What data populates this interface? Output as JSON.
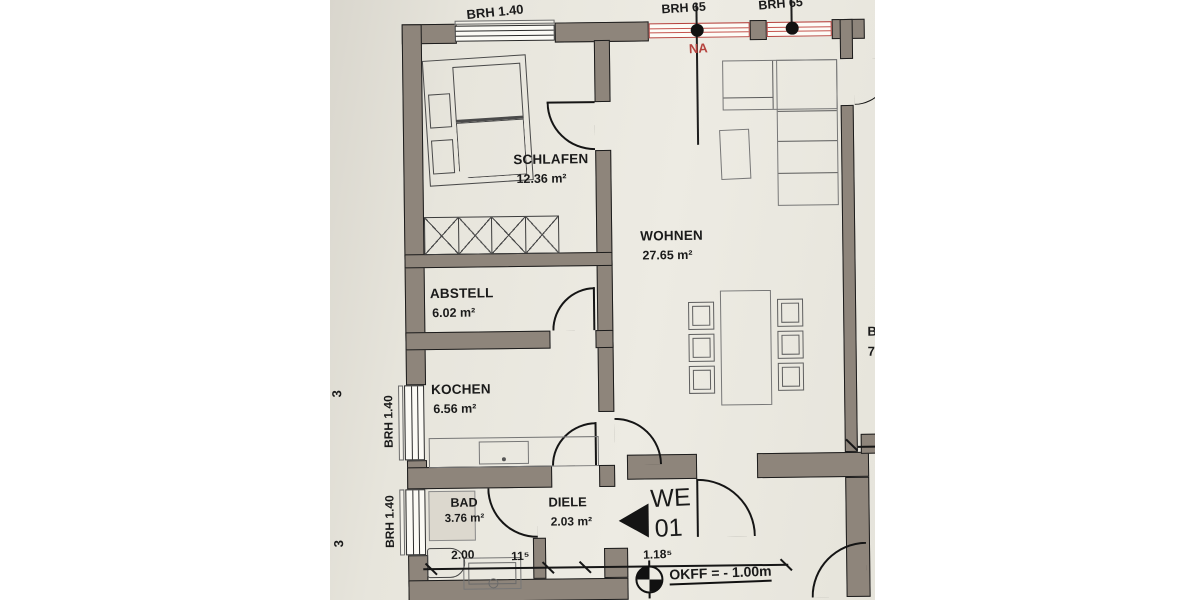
{
  "palette": {
    "paper": "#e9e6dd",
    "wall_grey": "#8e857b",
    "ink": "#1a1a1a",
    "window_red": "#b5433e"
  },
  "rooms": {
    "schlafen": {
      "name": "SCHLAFEN",
      "area": "12.36 m²"
    },
    "wohnen": {
      "name": "WOHNEN",
      "area": "27.65 m²"
    },
    "abstell": {
      "name": "ABSTELL",
      "area": "6.02 m²"
    },
    "kochen": {
      "name": "KOCHEN",
      "area": "6.56 m²"
    },
    "bad": {
      "name": "BAD",
      "area": "3.76 m²"
    },
    "diele": {
      "name": "DIELE",
      "area": "2.03 m²"
    }
  },
  "window_labels": {
    "top_schlafen": "BRH 1.40",
    "top_wohnen_left": "BRH 65",
    "top_wohnen_right": "BRH 65",
    "left_kochen": "BRH 1.40",
    "left_bad": "BRH 1.40",
    "na": "NA"
  },
  "dimensions": {
    "bad_width": "2.00",
    "wall_thickness": "11⁵",
    "diele_width": "1.18⁵"
  },
  "unit_marker": {
    "line1": "WE",
    "line2": "01"
  },
  "level_note": "OKFF = - 1.00m",
  "partial_text": {
    "right_room_line1": "B",
    "right_room_line2": "7",
    "left_edge_top": "3",
    "left_edge_bottom": "3"
  }
}
